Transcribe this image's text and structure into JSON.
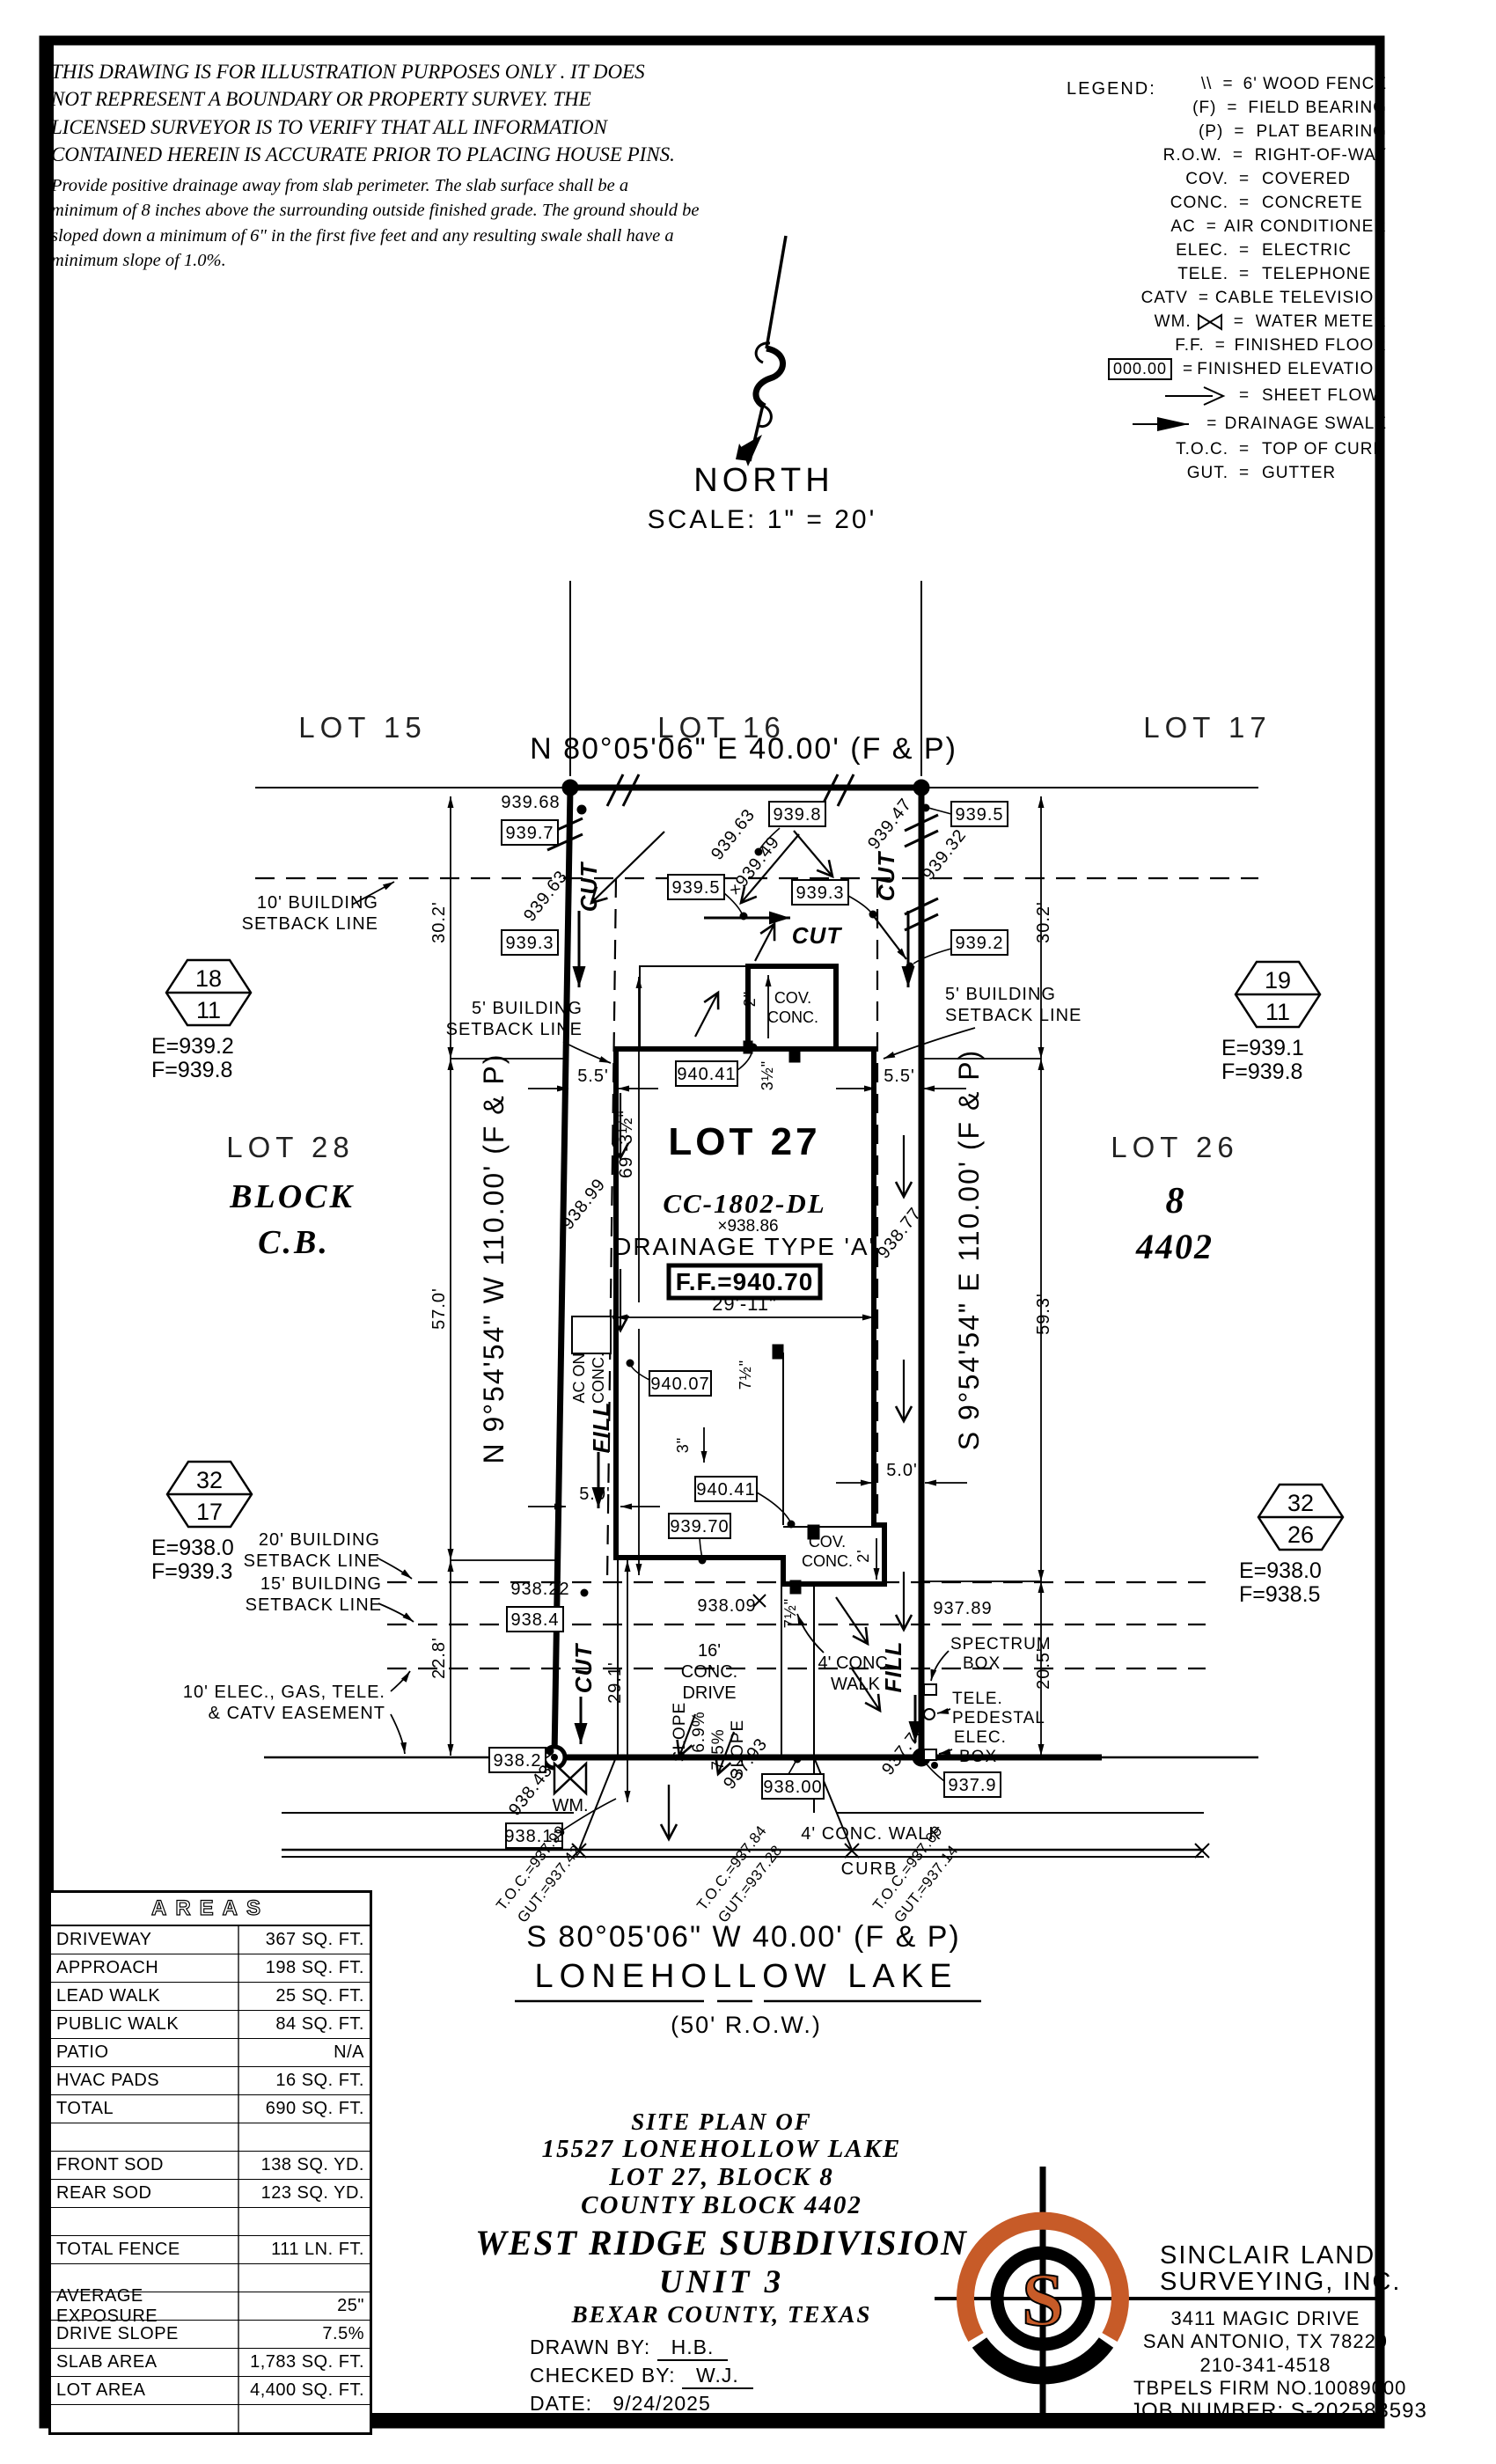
{
  "colors": {
    "ink": "#000000",
    "accent": "#C75B28"
  },
  "disclaimer": {
    "p1l1": "THIS DRAWING IS FOR ILLUSTRATION PURPOSES ONLY . IT DOES",
    "p1l2": "NOT REPRESENT A BOUNDARY OR PROPERTY SURVEY. THE",
    "p1l3": "LICENSED SURVEYOR IS TO VERIFY THAT ALL INFORMATION",
    "p1l4": "CONTAINED HEREIN IS ACCURATE PRIOR TO PLACING HOUSE PINS.",
    "p2l1": "Provide positive drainage away from slab perimeter. The slab surface shall be a",
    "p2l2": "minimum of 8 inches above the surrounding outside finished grade. The ground should be",
    "p2l3": "sloped down a minimum of 6\" in the first five feet and any resulting swale shall have a",
    "p2l4": "minimum slope of 1.0%."
  },
  "legend": {
    "title": "LEGEND:",
    "eq": "=",
    "rows": [
      {
        "sym": "\\\\",
        "desc": "6' WOOD FENCE"
      },
      {
        "sym": "(F)",
        "desc": "FIELD BEARING"
      },
      {
        "sym": "(P)",
        "desc": "PLAT BEARING"
      },
      {
        "sym": "R.O.W.",
        "desc": "RIGHT-OF-WAY"
      },
      {
        "sym": "COV.",
        "desc": "COVERED"
      },
      {
        "sym": "CONC.",
        "desc": "CONCRETE"
      },
      {
        "sym": "AC",
        "desc": "AIR CONDITIONER"
      },
      {
        "sym": "ELEC.",
        "desc": "ELECTRIC"
      },
      {
        "sym": "TELE.",
        "desc": "TELEPHONE"
      },
      {
        "sym": "CATV",
        "desc": "CABLE TELEVISION"
      },
      {
        "sym": "WM.",
        "desc": "WATER METER"
      },
      {
        "sym": "F.F.",
        "desc": "FINISHED FLOOR"
      },
      {
        "sym": "000.00",
        "desc": "FINISHED ELEVATION"
      },
      {
        "sym": "",
        "desc": "SHEET FLOW"
      },
      {
        "sym": "",
        "desc": "DRAINAGE SWALE"
      },
      {
        "sym": "T.O.C.",
        "desc": "TOP OF CURB"
      },
      {
        "sym": "GUT.",
        "desc": "GUTTER"
      }
    ]
  },
  "north": {
    "label": "NORTH",
    "scale": "SCALE: 1\" = 20'"
  },
  "plan": {
    "lots": {
      "lot15": "LOT 15",
      "lot16": "LOT 16",
      "lot17": "LOT 17",
      "lot27": "LOT 27",
      "lot28": "LOT 28",
      "block": "BLOCK",
      "cb": "C.B.",
      "lot26": "LOT 26",
      "blk8": "8",
      "cb4402": "4402"
    },
    "bearings": {
      "north": "N 80°05'06\" E 40.00' (F & P)",
      "south": "S 80°05'06\" W 40.00' (F & P)",
      "west": "N 9°54'54\" W 110.00' (F & P)",
      "east": "S 9°54'54\" E 110.00' (F & P)"
    },
    "street": {
      "name": "LONEHOLLOW LAKE",
      "row": "(50' R.O.W.)",
      "curb": "CURB",
      "walk": "4' CONC. WALK"
    },
    "monuments": [
      {
        "top": "18",
        "bot": "11",
        "e": "E=939.2",
        "f": "F=939.8"
      },
      {
        "top": "19",
        "bot": "11",
        "e": "E=939.1",
        "f": "F=939.8"
      },
      {
        "top": "32",
        "bot": "17",
        "e": "E=938.0",
        "f": "F=939.3"
      },
      {
        "top": "32",
        "bot": "26",
        "e": "E=938.0",
        "f": "F=938.5"
      }
    ],
    "setbacks": {
      "sb10": "10' BUILDING",
      "sb5": "5' BUILDING",
      "sb20": "20' BUILDING",
      "sb15": "15' BUILDING",
      "sbline": "SETBACK LINE",
      "easea": "10' ELEC., GAS, TELE.",
      "easeb": "& CATV EASEMENT"
    },
    "dims": {
      "d30_2": "30.2'",
      "d57": "57.0'",
      "d59_3": "59.3'",
      "d22_8": "22.8'",
      "d20_5": "20.5'",
      "d5_5": "5.5'",
      "d5_0": "5.0'",
      "d29_11": "29'-11\"",
      "d69": "69'-3½\"",
      "d29_1": "29.1'",
      "d2in": "2\"",
      "d2ft": "2'",
      "d3in": "3\"",
      "d3_5": "3½\"",
      "d7_5": "7½\""
    },
    "house": {
      "model": "CC-1802-DL",
      "spot": "×938.86",
      "drainage": "DRAINAGE TYPE 'A'",
      "ff": "F.F.=940.70",
      "cov1": "COV.",
      "cov2": "CONC.",
      "drive1": "16'",
      "drive2": "CONC.",
      "drive3": "DRIVE",
      "leadwalk1": "4' CONC.",
      "leadwalk2": "WALK"
    },
    "flow": {
      "cut": "CUT",
      "fill": "FILL",
      "slope1a": "SLOPE",
      "slope1b": "6.9%",
      "slope2a": "7.5%",
      "slope2b": "SLOPE"
    },
    "util": {
      "wm": "WM.",
      "ac1": "AC ON",
      "ac2": "CONC.",
      "spec1": "SPECTRUM",
      "spec2": "BOX",
      "tele1": "TELE.",
      "tele2": "PEDESTAL",
      "elec1": "ELEC.",
      "elec2": "BOX"
    },
    "elev": {
      "e939_68": "939.68",
      "e939_7": "939.7",
      "e939_8": "939.8",
      "e939_5": "939.5",
      "e939_3": "939.3",
      "e939_2": "939.2",
      "e939_63": "939.63",
      "e939_49": "×939.49",
      "e939_47": "939.47",
      "e939_32": "939.32",
      "e940_41": "940.41",
      "e940_07": "940.07",
      "e939_70": "939.70",
      "e938_99": "938.99",
      "e938_77": "938.77",
      "e938_22": "938.22",
      "e938_4": "938.4",
      "e938_09": "938.09",
      "e937_89": "937.89",
      "e938_2": "938.2",
      "e938_43": "938.43",
      "e938_12": "938.12",
      "e938_00": "938.00",
      "e937_9": "937.9",
      "e937_93": "937.93",
      "e937_70": "937.70"
    },
    "curb": {
      "t1": "T.O.C.=937.99",
      "g1": "GUT.=937.42",
      "t2": "T.O.C.=937.84",
      "g2": "GUT.=937.28",
      "t3": "T.O.C.=937.69",
      "g3": "GUT.=937.14"
    }
  },
  "areas": {
    "title": "AREAS",
    "rows": [
      {
        "label": "DRIVEWAY",
        "value": "367 SQ. FT."
      },
      {
        "label": "APPROACH",
        "value": "198 SQ. FT."
      },
      {
        "label": "LEAD WALK",
        "value": "25 SQ. FT."
      },
      {
        "label": "PUBLIC WALK",
        "value": "84 SQ. FT."
      },
      {
        "label": "PATIO",
        "value": "N/A"
      },
      {
        "label": "HVAC PADS",
        "value": "16 SQ. FT."
      },
      {
        "label": "TOTAL",
        "value": "690 SQ. FT."
      },
      {
        "label": "",
        "value": ""
      },
      {
        "label": "FRONT SOD",
        "value": "138 SQ. YD."
      },
      {
        "label": "REAR SOD",
        "value": "123 SQ. YD."
      },
      {
        "label": "",
        "value": ""
      },
      {
        "label": "TOTAL FENCE",
        "value": "111 LN. FT."
      },
      {
        "label": "",
        "value": ""
      },
      {
        "label": "AVERAGE EXPOSURE",
        "value": "25\""
      },
      {
        "label": "DRIVE SLOPE",
        "value": "7.5%"
      },
      {
        "label": "SLAB AREA",
        "value": "1,783 SQ. FT."
      },
      {
        "label": "LOT AREA",
        "value": "4,400 SQ. FT."
      },
      {
        "label": "",
        "value": ""
      }
    ]
  },
  "title_block": {
    "l1": "SITE PLAN OF",
    "l2": "15527 LONEHOLLOW LAKE",
    "l3": "LOT 27, BLOCK 8",
    "l4": "COUNTY BLOCK 4402",
    "l5": "WEST RIDGE SUBDIVISION",
    "l6": "UNIT 3",
    "l7": "BEXAR COUNTY, TEXAS",
    "drawn_label": "DRAWN BY:",
    "drawn": "H.B.",
    "checked_label": "CHECKED BY:",
    "checked": "W.J.",
    "date_label": "DATE:",
    "date": "9/24/2025"
  },
  "firm": {
    "name1": "SINCLAIR LAND",
    "name2": "SURVEYING, INC.",
    "addr1": "3411 MAGIC DRIVE",
    "addr2": "SAN ANTONIO, TX 78229",
    "phone": "210-341-4518",
    "tbpels": "TBPELS FIRM NO.10089000",
    "job": "JOB NUMBER: S-202583593",
    "logo_s": "S"
  }
}
